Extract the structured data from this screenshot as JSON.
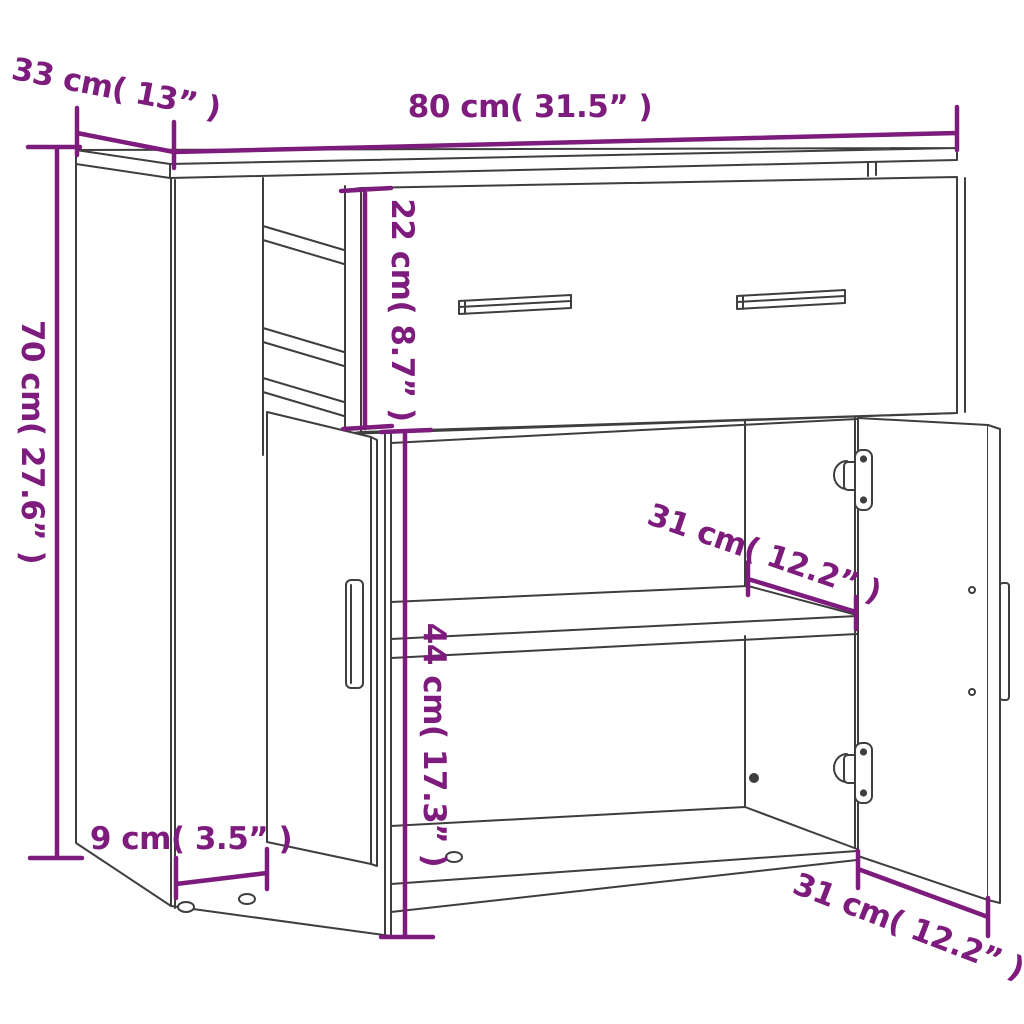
{
  "figure": {
    "description": "Line drawing of a sideboard cabinet with open drawer and two open doors, annotated with measurements"
  },
  "colors": {
    "dimension_accent": "#7d1c7d",
    "furniture_line": "#3e3e3e",
    "background": "#ffffff"
  },
  "dimensions": {
    "width": {
      "label": "80 cm( 31.5” )",
      "cm": 80,
      "inches": 31.5
    },
    "depth": {
      "label": "33 cm( 13” )",
      "cm": 33,
      "inches": 13
    },
    "height": {
      "label": "70 cm( 27.6” )",
      "cm": 70,
      "inches": 27.6
    },
    "drawer_height": {
      "label": "22 cm( 8.7” )",
      "cm": 22,
      "inches": 8.7
    },
    "shelf_depth": {
      "label": "31 cm( 12.2” )",
      "cm": 31,
      "inches": 12.2
    },
    "compartment_height": {
      "label": "44 cm( 17.3” )",
      "cm": 44,
      "inches": 17.3
    },
    "base_height": {
      "label": "9 cm( 3.5” )",
      "cm": 9,
      "inches": 3.5
    },
    "door_width": {
      "label": "31 cm( 12.2” )",
      "cm": 31,
      "inches": 12.2
    }
  }
}
